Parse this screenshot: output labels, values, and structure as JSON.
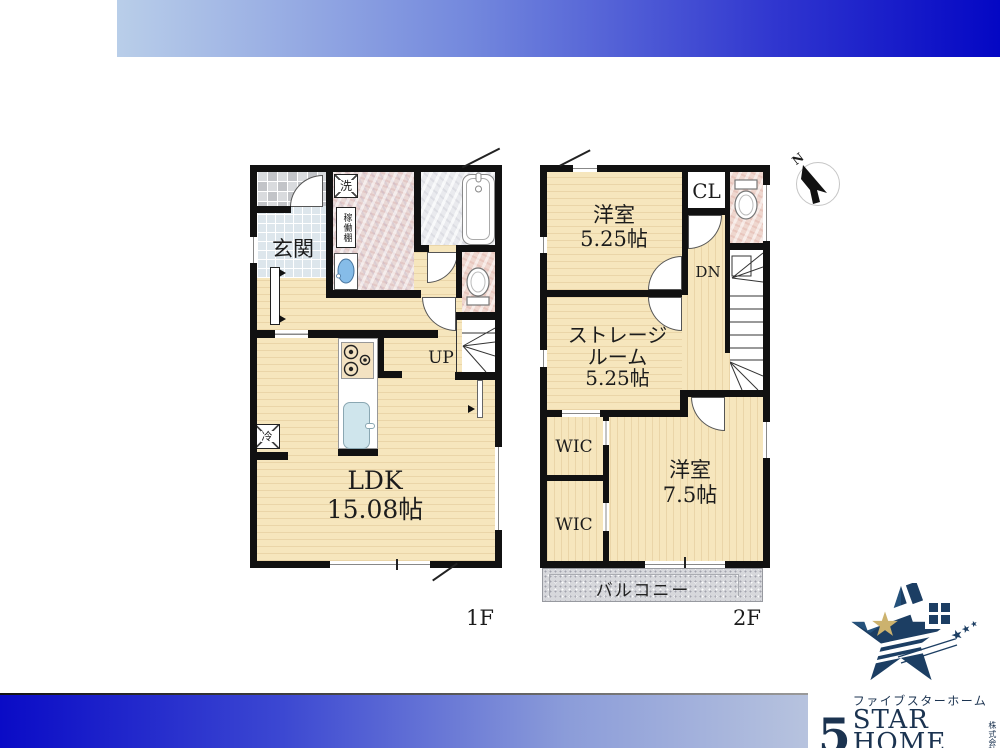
{
  "compass": {
    "north": "N"
  },
  "floor1": {
    "label": "1F",
    "rooms": {
      "genkan": "玄関",
      "laundry": "洗",
      "shelf": "稼働棚",
      "up": "UP",
      "ldk_line1": "LDK",
      "ldk_line2": "15.08帖",
      "fridge": "冷"
    }
  },
  "floor2": {
    "label": "2F",
    "rooms": {
      "bedroom1_line1": "洋室",
      "bedroom1_line2": "5.25帖",
      "closet": "CL",
      "down": "DN",
      "storage_line1": "ストレージ",
      "storage_line2": "ルーム",
      "storage_line3": "5.25帖",
      "wic_upper": "WIC",
      "wic_lower": "WIC",
      "bedroom2_line1": "洋室",
      "bedroom2_line2": "7.5帖",
      "balcony": "バルコニー"
    }
  },
  "logo": {
    "five": "5",
    "katakana": "ファイブスターホーム",
    "latin": "STAR HOME",
    "corp_top": "株式",
    "corp_bottom": "会社"
  },
  "colors": {
    "banner_light": "#b9cee9",
    "banner_dark": "#0407c4",
    "wall": "#111111",
    "wood_floor": "#f6e6bd",
    "marble_pink": "#efd7cf",
    "logo_navy": "#1c3e63",
    "logo_gold": "#ccb26e"
  }
}
